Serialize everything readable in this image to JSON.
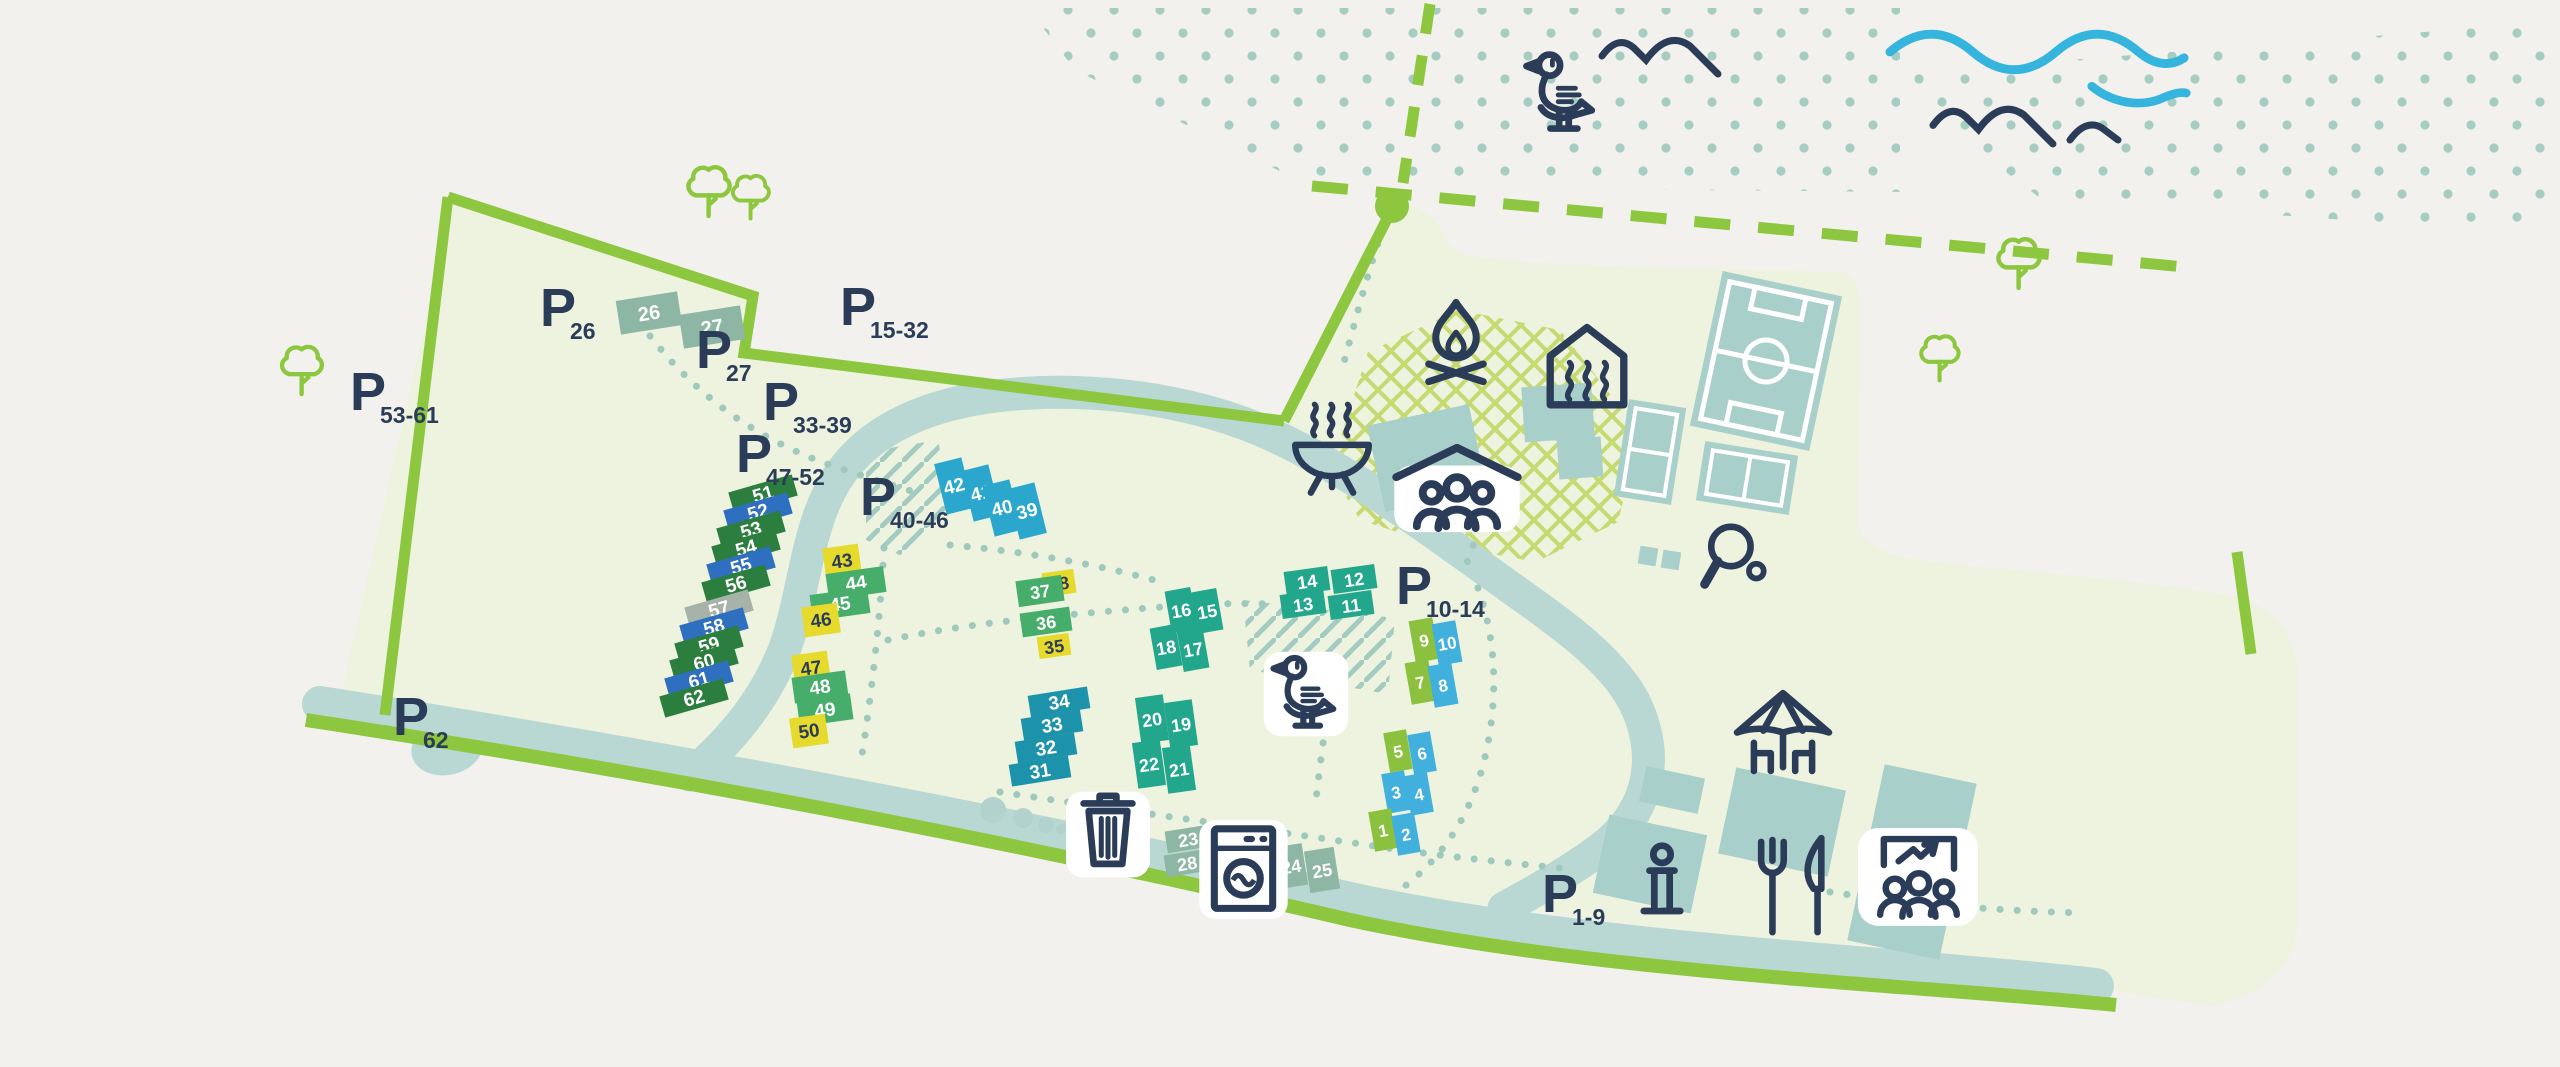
{
  "map": {
    "parking_glyph": "P",
    "colors": {
      "background": "#f2f1ed",
      "park": "#edf3de",
      "road_green": "#8dc63f",
      "river": "#b9d8d3",
      "building": "#a9cfca",
      "dots": "#a6cdc2",
      "navy": "#2b3c59",
      "wave_blue": "#35b4de",
      "crosshatch": "#c6da72",
      "dg": "#2c7e3e",
      "mg": "#46ae6a",
      "lm": "#8cc03f",
      "yl": "#e6da2d",
      "cy": "#2ba7ce",
      "lb": "#41b0dc",
      "te": "#22a68c",
      "tb": "#1d93ab",
      "bl": "#2e6fc0",
      "gy": "#a7b2a9",
      "sg": "#8eb6a4"
    },
    "parking": [
      {
        "sub": "26",
        "x": 540,
        "y": 326
      },
      {
        "sub": "27",
        "x": 696,
        "y": 368
      },
      {
        "sub": "15-32",
        "x": 840,
        "y": 325
      },
      {
        "sub": "33-39",
        "x": 763,
        "y": 420
      },
      {
        "sub": "47-52",
        "x": 736,
        "y": 472
      },
      {
        "sub": "40-46",
        "x": 860,
        "y": 515
      },
      {
        "sub": "53-61",
        "x": 350,
        "y": 410
      },
      {
        "sub": "62",
        "x": 393,
        "y": 735
      },
      {
        "sub": "10-14",
        "x": 1396,
        "y": 604
      },
      {
        "sub": "1-9",
        "x": 1542,
        "y": 912
      }
    ],
    "plots": [
      {
        "n": "26",
        "x": 649,
        "y": 313,
        "w": 62,
        "h": 34,
        "r": -9,
        "c": "sg",
        "t": "w",
        "fs": 20
      },
      {
        "n": "27",
        "x": 712,
        "y": 327,
        "w": 62,
        "h": 34,
        "r": -9,
        "c": "sg",
        "t": "w",
        "fs": 20
      },
      {
        "n": "51",
        "x": 763,
        "y": 494,
        "w": 66,
        "h": 22,
        "r": -16,
        "c": "dg",
        "t": "w",
        "fs": 19
      },
      {
        "n": "52",
        "x": 758,
        "y": 512,
        "w": 66,
        "h": 22,
        "r": -16,
        "c": "bl",
        "t": "w",
        "fs": 19
      },
      {
        "n": "53",
        "x": 751,
        "y": 530,
        "w": 66,
        "h": 22,
        "r": -16,
        "c": "dg",
        "t": "w",
        "fs": 19
      },
      {
        "n": "54",
        "x": 746,
        "y": 548,
        "w": 66,
        "h": 22,
        "r": -16,
        "c": "dg",
        "t": "w",
        "fs": 19
      },
      {
        "n": "55",
        "x": 741,
        "y": 566,
        "w": 66,
        "h": 22,
        "r": -16,
        "c": "bl",
        "t": "w",
        "fs": 19
      },
      {
        "n": "56",
        "x": 736,
        "y": 584,
        "w": 66,
        "h": 22,
        "r": -16,
        "c": "dg",
        "t": "w",
        "fs": 19
      },
      {
        "n": "57",
        "x": 719,
        "y": 609,
        "w": 66,
        "h": 22,
        "r": -16,
        "c": "gy",
        "t": "w",
        "fs": 19
      },
      {
        "n": "58",
        "x": 714,
        "y": 627,
        "w": 66,
        "h": 22,
        "r": -16,
        "c": "bl",
        "t": "w",
        "fs": 19
      },
      {
        "n": "59",
        "x": 709,
        "y": 645,
        "w": 66,
        "h": 22,
        "r": -16,
        "c": "dg",
        "t": "w",
        "fs": 19
      },
      {
        "n": "60",
        "x": 704,
        "y": 662,
        "w": 66,
        "h": 22,
        "r": -16,
        "c": "dg",
        "t": "w",
        "fs": 19
      },
      {
        "n": "61",
        "x": 699,
        "y": 680,
        "w": 66,
        "h": 22,
        "r": -16,
        "c": "bl",
        "t": "w",
        "fs": 19
      },
      {
        "n": "62",
        "x": 694,
        "y": 698,
        "w": 66,
        "h": 22,
        "r": -16,
        "c": "dg",
        "t": "w",
        "fs": 19
      },
      {
        "n": "43",
        "x": 842,
        "y": 561,
        "w": 36,
        "h": 30,
        "r": -8,
        "c": "yl",
        "t": "d",
        "fs": 19
      },
      {
        "n": "44",
        "x": 856,
        "y": 583,
        "w": 58,
        "h": 26,
        "r": -8,
        "c": "mg",
        "t": "w",
        "fs": 19
      },
      {
        "n": "45",
        "x": 840,
        "y": 604,
        "w": 58,
        "h": 26,
        "r": -8,
        "c": "mg",
        "t": "w",
        "fs": 19
      },
      {
        "n": "46",
        "x": 821,
        "y": 620,
        "w": 36,
        "h": 30,
        "r": -8,
        "c": "yl",
        "t": "d",
        "fs": 19
      },
      {
        "n": "47",
        "x": 811,
        "y": 668,
        "w": 36,
        "h": 30,
        "r": -8,
        "c": "yl",
        "t": "d",
        "fs": 19
      },
      {
        "n": "48",
        "x": 820,
        "y": 687,
        "w": 54,
        "h": 26,
        "r": -8,
        "c": "mg",
        "t": "w",
        "fs": 19
      },
      {
        "n": "49",
        "x": 825,
        "y": 710,
        "w": 54,
        "h": 26,
        "r": -8,
        "c": "mg",
        "t": "w",
        "fs": 19
      },
      {
        "n": "50",
        "x": 809,
        "y": 731,
        "w": 36,
        "h": 30,
        "r": -8,
        "c": "yl",
        "t": "d",
        "fs": 19
      },
      {
        "n": "42",
        "x": 954,
        "y": 486,
        "w": 28,
        "h": 52,
        "r": -14,
        "c": "cy",
        "t": "w",
        "fs": 19
      },
      {
        "n": "41",
        "x": 981,
        "y": 493,
        "w": 28,
        "h": 52,
        "r": -14,
        "c": "cy",
        "t": "w",
        "fs": 19
      },
      {
        "n": "40",
        "x": 1002,
        "y": 508,
        "w": 28,
        "h": 52,
        "r": -14,
        "c": "cy",
        "t": "w",
        "fs": 19
      },
      {
        "n": "39",
        "x": 1027,
        "y": 511,
        "w": 28,
        "h": 52,
        "r": -14,
        "c": "cy",
        "t": "w",
        "fs": 19
      },
      {
        "n": "38",
        "x": 1059,
        "y": 583,
        "w": 32,
        "h": 24,
        "r": -8,
        "c": "yl",
        "t": "d",
        "fs": 18
      },
      {
        "n": "37",
        "x": 1040,
        "y": 591,
        "w": 46,
        "h": 26,
        "r": -8,
        "c": "mg",
        "t": "w",
        "fs": 18
      },
      {
        "n": "36",
        "x": 1046,
        "y": 622,
        "w": 50,
        "h": 24,
        "r": -8,
        "c": "mg",
        "t": "w",
        "fs": 18
      },
      {
        "n": "35",
        "x": 1054,
        "y": 646,
        "w": 32,
        "h": 22,
        "r": -8,
        "c": "yl",
        "t": "d",
        "fs": 18
      },
      {
        "n": "16",
        "x": 1181,
        "y": 610,
        "w": 26,
        "h": 42,
        "r": -10,
        "c": "te",
        "t": "w",
        "fs": 18
      },
      {
        "n": "15",
        "x": 1207,
        "y": 611,
        "w": 26,
        "h": 42,
        "r": -10,
        "c": "te",
        "t": "w",
        "fs": 18
      },
      {
        "n": "18",
        "x": 1166,
        "y": 647,
        "w": 26,
        "h": 42,
        "r": -10,
        "c": "te",
        "t": "w",
        "fs": 18
      },
      {
        "n": "17",
        "x": 1193,
        "y": 649,
        "w": 26,
        "h": 42,
        "r": -10,
        "c": "te",
        "t": "w",
        "fs": 18
      },
      {
        "n": "14",
        "x": 1307,
        "y": 581,
        "w": 44,
        "h": 24,
        "r": -8,
        "c": "te",
        "t": "w",
        "fs": 18
      },
      {
        "n": "12",
        "x": 1354,
        "y": 579,
        "w": 44,
        "h": 24,
        "r": -8,
        "c": "te",
        "t": "w",
        "fs": 18
      },
      {
        "n": "13",
        "x": 1303,
        "y": 604,
        "w": 44,
        "h": 24,
        "r": -8,
        "c": "te",
        "t": "w",
        "fs": 18
      },
      {
        "n": "11",
        "x": 1351,
        "y": 605,
        "w": 44,
        "h": 24,
        "r": -8,
        "c": "te",
        "t": "w",
        "fs": 18
      },
      {
        "n": "34",
        "x": 1059,
        "y": 702,
        "w": 60,
        "h": 22,
        "r": -9,
        "c": "tb",
        "t": "w",
        "fs": 19
      },
      {
        "n": "33",
        "x": 1052,
        "y": 725,
        "w": 60,
        "h": 22,
        "r": -9,
        "c": "tb",
        "t": "w",
        "fs": 19
      },
      {
        "n": "32",
        "x": 1046,
        "y": 748,
        "w": 60,
        "h": 22,
        "r": -9,
        "c": "tb",
        "t": "w",
        "fs": 19
      },
      {
        "n": "31",
        "x": 1040,
        "y": 771,
        "w": 60,
        "h": 22,
        "r": -9,
        "c": "tb",
        "t": "w",
        "fs": 19
      },
      {
        "n": "20",
        "x": 1152,
        "y": 719,
        "w": 28,
        "h": 46,
        "r": -8,
        "c": "te",
        "t": "w",
        "fs": 18
      },
      {
        "n": "19",
        "x": 1181,
        "y": 724,
        "w": 28,
        "h": 46,
        "r": -8,
        "c": "te",
        "t": "w",
        "fs": 18
      },
      {
        "n": "22",
        "x": 1149,
        "y": 764,
        "w": 28,
        "h": 46,
        "r": -8,
        "c": "te",
        "t": "w",
        "fs": 18
      },
      {
        "n": "21",
        "x": 1179,
        "y": 769,
        "w": 28,
        "h": 46,
        "r": -8,
        "c": "te",
        "t": "w",
        "fs": 18
      },
      {
        "n": "9",
        "x": 1424,
        "y": 640,
        "w": 24,
        "h": 42,
        "r": -10,
        "c": "lm",
        "t": "w",
        "fs": 17
      },
      {
        "n": "10",
        "x": 1447,
        "y": 643,
        "w": 24,
        "h": 42,
        "r": -10,
        "c": "lb",
        "t": "w",
        "fs": 17
      },
      {
        "n": "7",
        "x": 1420,
        "y": 682,
        "w": 24,
        "h": 42,
        "r": -10,
        "c": "lm",
        "t": "w",
        "fs": 17
      },
      {
        "n": "8",
        "x": 1443,
        "y": 685,
        "w": 24,
        "h": 42,
        "r": -10,
        "c": "lb",
        "t": "w",
        "fs": 17
      },
      {
        "n": "5",
        "x": 1398,
        "y": 751,
        "w": 23,
        "h": 40,
        "r": -10,
        "c": "lm",
        "t": "w",
        "fs": 17
      },
      {
        "n": "6",
        "x": 1422,
        "y": 753,
        "w": 23,
        "h": 40,
        "r": -10,
        "c": "lb",
        "t": "w",
        "fs": 17
      },
      {
        "n": "3",
        "x": 1396,
        "y": 792,
        "w": 23,
        "h": 40,
        "r": -10,
        "c": "lb",
        "t": "w",
        "fs": 17
      },
      {
        "n": "4",
        "x": 1419,
        "y": 794,
        "w": 23,
        "h": 40,
        "r": -10,
        "c": "lb",
        "t": "w",
        "fs": 17
      },
      {
        "n": "1",
        "x": 1383,
        "y": 830,
        "w": 23,
        "h": 40,
        "r": -10,
        "c": "lm",
        "t": "w",
        "fs": 17
      },
      {
        "n": "2",
        "x": 1406,
        "y": 834,
        "w": 23,
        "h": 40,
        "r": -10,
        "c": "lb",
        "t": "w",
        "fs": 17
      },
      {
        "n": "23",
        "x": 1188,
        "y": 839,
        "w": 44,
        "h": 22,
        "r": -9,
        "c": "sg",
        "t": "w",
        "fs": 18
      },
      {
        "n": "28",
        "x": 1187,
        "y": 863,
        "w": 44,
        "h": 22,
        "r": -9,
        "c": "sg",
        "t": "w",
        "fs": 18
      },
      {
        "n": "24",
        "x": 1291,
        "y": 866,
        "w": 28,
        "h": 42,
        "r": -9,
        "c": "sg",
        "t": "w",
        "fs": 18
      },
      {
        "n": "25",
        "x": 1322,
        "y": 870,
        "w": 30,
        "h": 42,
        "r": -9,
        "c": "sg",
        "t": "w",
        "fs": 18
      }
    ],
    "icons": [
      {
        "s": "sym-campfire",
        "n": "campfire-icon",
        "x": 1412,
        "y": 298,
        "w": 88,
        "h": 88,
        "c": true
      },
      {
        "s": "sym-sauna",
        "n": "sauna-icon",
        "x": 1541,
        "y": 322,
        "w": 92,
        "h": 92,
        "c": true
      },
      {
        "s": "sym-bbq",
        "n": "bbq-icon",
        "x": 1286,
        "y": 400,
        "w": 92,
        "h": 98,
        "c": true
      },
      {
        "s": "sym-shelter",
        "n": "group-shelter-icon",
        "x": 1388,
        "y": 438,
        "w": 138,
        "h": 98,
        "c": true
      },
      {
        "s": "sym-pingpong",
        "n": "table-tennis-icon",
        "x": 1694,
        "y": 517,
        "w": 82,
        "h": 82,
        "c": true
      },
      {
        "s": "sym-duck",
        "n": "duck-icon",
        "x": 1262,
        "y": 648,
        "w": 88,
        "h": 92,
        "c": true
      },
      {
        "s": "sym-trash",
        "n": "trash-icon",
        "x": 1066,
        "y": 784,
        "w": 84,
        "h": 96,
        "c": true
      },
      {
        "s": "sym-washer",
        "n": "washing-machine-icon",
        "x": 1199,
        "y": 820,
        "w": 89,
        "h": 99,
        "c": true
      },
      {
        "s": "sym-umbrella",
        "n": "terrace-umbrella-icon",
        "x": 1722,
        "y": 688,
        "w": 122,
        "h": 104,
        "c": true
      },
      {
        "s": "sym-info",
        "n": "info-point-icon",
        "x": 1628,
        "y": 838,
        "w": 68,
        "h": 96,
        "c": true
      },
      {
        "s": "sym-fork",
        "n": "restaurant-icon",
        "x": 1748,
        "y": 834,
        "w": 94,
        "h": 106,
        "c": true
      },
      {
        "s": "sym-meeting",
        "n": "meeting-room-icon",
        "x": 1858,
        "y": 824,
        "w": 120,
        "h": 104,
        "c": true
      },
      {
        "s": "sym-gull",
        "n": "seagull-icon",
        "x": 1514,
        "y": 44,
        "w": 96,
        "h": 100,
        "c": false
      },
      {
        "s": "sym-mountains",
        "n": "mountains-icon",
        "x": 1596,
        "y": 16,
        "w": 130,
        "h": 62,
        "c": false
      },
      {
        "s": "sym-mountains",
        "n": "mountains-icon",
        "x": 1918,
        "y": 84,
        "w": 152,
        "h": 64,
        "c": false
      },
      {
        "s": "sym-hill",
        "n": "hill-icon",
        "x": 2064,
        "y": 106,
        "w": 60,
        "h": 40,
        "c": false
      },
      {
        "s": "sym-wave",
        "n": "wave-icon",
        "x": 1884,
        "y": 18,
        "w": 306,
        "h": 60,
        "c": false
      },
      {
        "s": "sym-wave2",
        "n": "wave-icon",
        "x": 2086,
        "y": 76,
        "w": 106,
        "h": 36,
        "c": false
      },
      {
        "s": "sym-tree",
        "n": "tree-icon",
        "x": 676,
        "y": 156,
        "w": 64,
        "h": 66,
        "c": false
      },
      {
        "s": "sym-tree",
        "n": "tree-icon",
        "x": 722,
        "y": 166,
        "w": 56,
        "h": 58,
        "c": false
      },
      {
        "s": "sym-tree",
        "n": "tree-icon",
        "x": 270,
        "y": 336,
        "w": 62,
        "h": 64,
        "c": false
      },
      {
        "s": "sym-tree",
        "n": "tree-icon",
        "x": 1986,
        "y": 228,
        "w": 64,
        "h": 66,
        "c": false
      },
      {
        "s": "sym-tree",
        "n": "tree-icon",
        "x": 1910,
        "y": 326,
        "w": 58,
        "h": 60,
        "c": false
      }
    ]
  }
}
